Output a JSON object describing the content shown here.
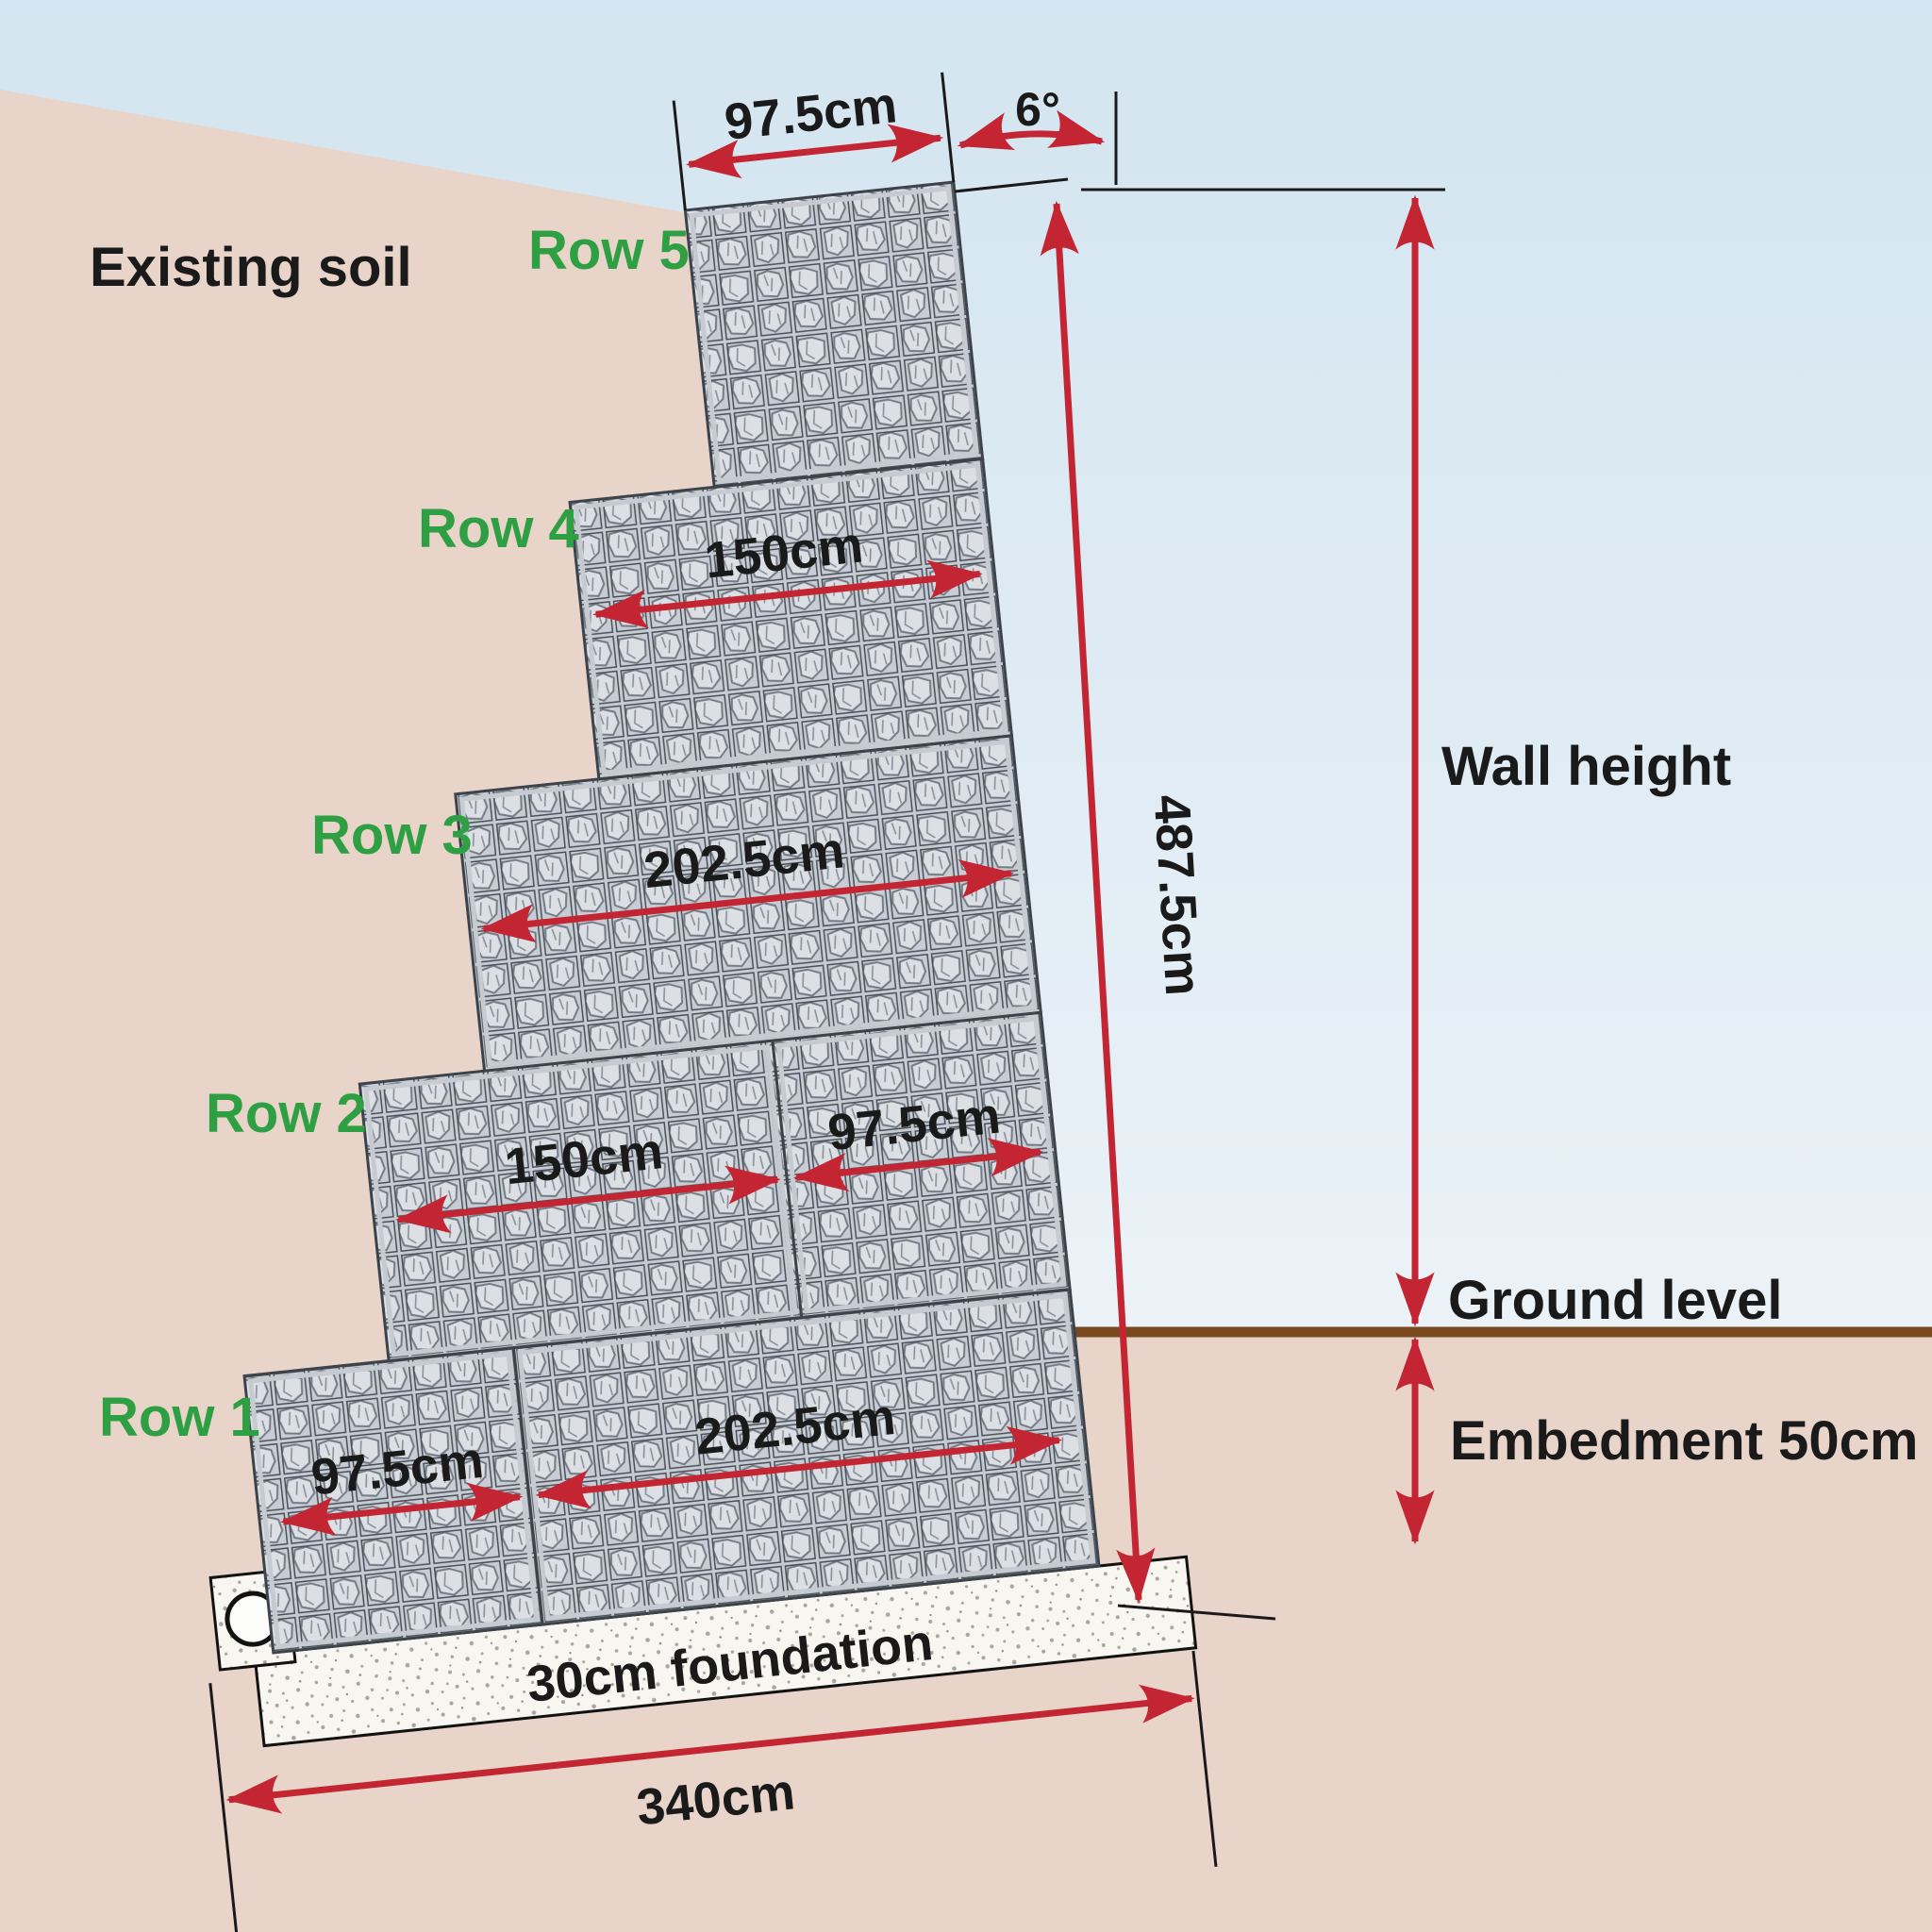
{
  "title": "Gabion retaining wall cross-section diagram",
  "soil": {
    "existing_label": "Existing soil"
  },
  "rows": [
    {
      "label": "Row 1",
      "dims": [
        "97.5cm",
        "202.5cm"
      ]
    },
    {
      "label": "Row 2",
      "dims": [
        "150cm",
        "97.5cm"
      ]
    },
    {
      "label": "Row 3",
      "dims": [
        "202.5cm"
      ]
    },
    {
      "label": "Row 4",
      "dims": [
        "150cm"
      ]
    },
    {
      "label": "Row 5",
      "dims": [
        "97.5cm"
      ]
    }
  ],
  "dimensions": {
    "batter_angle": "6°",
    "wall_length": "487.5cm",
    "wall_height_label": "Wall height",
    "ground_level_label": "Ground level",
    "embedment_label": "Embedment 50cm",
    "foundation_label": "30cm  foundation",
    "foundation_width": "340cm"
  },
  "colors": {
    "dimension_red": "#c32532",
    "row_label_green": "#2f9f44",
    "ground_brown": "#7a4a1e",
    "sky_blue": "#d4e6f1",
    "soil_pink": "#e8d4c9",
    "gabion_gray": "#ccd1d8",
    "concrete_white": "#f7f6f1",
    "text_black": "#1a1a1a"
  }
}
